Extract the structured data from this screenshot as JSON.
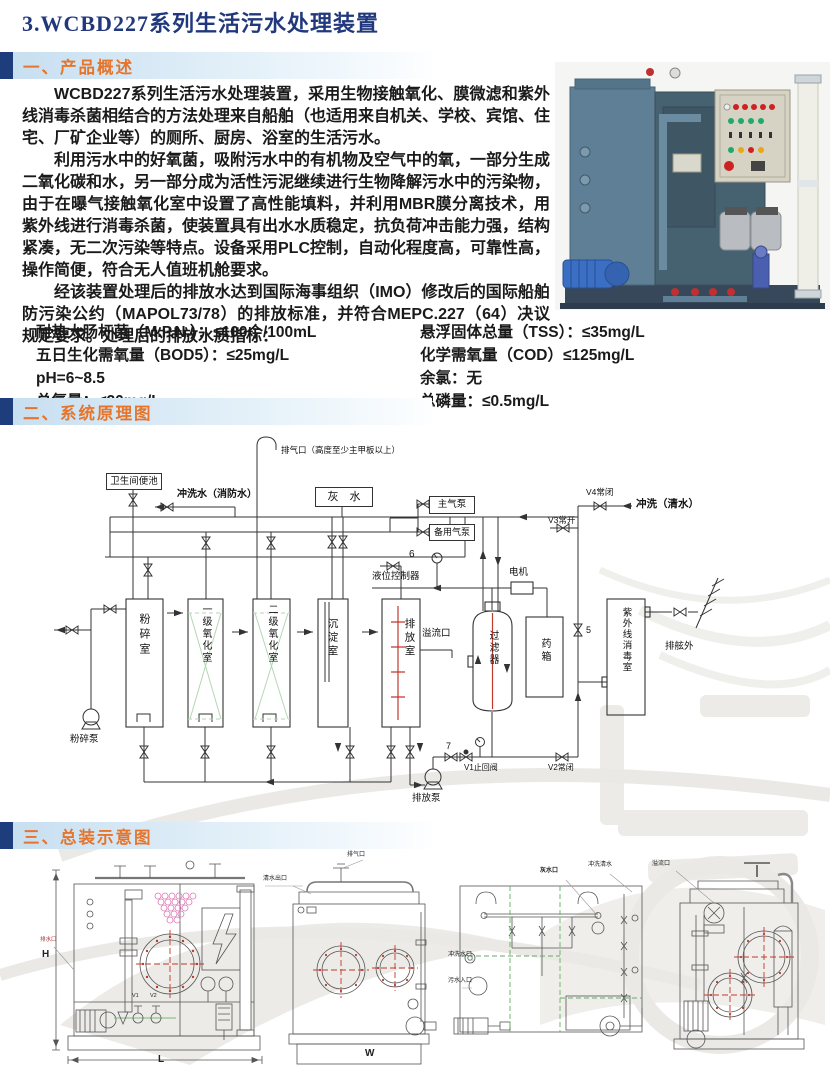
{
  "page_title": "3.WCBD227系列生活污水处理装置",
  "sections": {
    "overview": "一、产品概述",
    "schematic": "二、系统原理图",
    "assembly": "三、总装示意图"
  },
  "overview": {
    "p1": "WCBD227系列生活污水处理装置，采用生物接触氧化、膜微滤和紫外线消毒杀菌相结合的方法处理来自船舶（也适用来自机关、学校、宾馆、住宅、厂矿企业等）的厕所、厨房、浴室的生活污水。",
    "p2": "利用污水中的好氧菌，吸附污水中的有机物及空气中的氧，一部分生成二氧化碳和水，另一部分成为活性污泥继续进行生物降解污水中的污染物，由于在曝气接触氧化室中设置了高性能填料，并利用MBR膜分离技术，用紫外线进行消毒杀菌，使装置具有出水水质稳定，抗负荷冲击能力强，结构紧凑，无二次污染等特点。设备采用PLC控制，自动化程度高，可靠性高，操作简便，符合无人值班机舱要求。",
    "p3": "经该装置处理后的排放水达到国际海事组织（IMO）修改后的国际船舶防污染公约（MAPOL73/78）的排放标准，并符合MEPC.227（64）决议规定要求。处理后的排放水质指标：",
    "specs_left": [
      "耐热大肠杆菌（M.P.N.）：≤100个/100mL",
      "五日生化需氧量（BOD5）：≤25mg/L",
      "pH=6~8.5",
      "总氮量：≤20mg/L"
    ],
    "specs_right": [
      "悬浮固体总量（TSS）：≤35mg/L",
      "化学需氧量（COD）≤125mg/L",
      "余氯：无",
      "总磷量：≤0.5mg/L"
    ]
  },
  "schematic": {
    "vent": "排气口（高度至少主甲板以上）",
    "toilet": "卫生间便池",
    "flush_fire": "冲洗水（消防水）",
    "gray_water": "灰　水",
    "main_air_pump": "主气泵",
    "backup_air_pump": "备用气泵",
    "v4": "V4常闭",
    "flush_clean": "冲洗（清水）",
    "v3": "V3常开",
    "n6": "6",
    "level_controller": "液位控制器",
    "motor": "电机",
    "overflow": "溢流口",
    "tank1": "粉碎室",
    "tank2": "一级氧化室",
    "tank3": "二级氧化室",
    "tank4": "沉淀室",
    "tank5": "排放室",
    "filter": "过滤器",
    "chem_box": "药箱",
    "uv": "紫外线消毒室",
    "n5": "5",
    "overboard": "排舷外",
    "crush_pump": "粉碎泵",
    "discharge_pump": "排放泵",
    "n7": "7",
    "v1": "V1止回阀",
    "v2": "V2常闭"
  },
  "assembly": {
    "front": {
      "h": "H",
      "l": "L",
      "v1": "V1",
      "v2": "V2",
      "drain": "排水口"
    },
    "side": {
      "w": "W",
      "vent": "排气口",
      "clean_outlet": "清水出口"
    },
    "top": {
      "gray_port": "灰水口",
      "flush_clean": "冲洗清水",
      "flush_port": "冲洗水口",
      "sewage_inlet": "污水入口"
    },
    "side2": {
      "overflow": "溢流口"
    }
  },
  "colors": {
    "title_blue": "#21387c",
    "accent_orange": "#e5752c",
    "header_bar_blue": "#c6def0",
    "diagram_red": "#c0392b",
    "diagram_green": "#b5d6b5",
    "honeycomb_pink": "#df7ab8",
    "watermark_gray": "#ececea"
  }
}
